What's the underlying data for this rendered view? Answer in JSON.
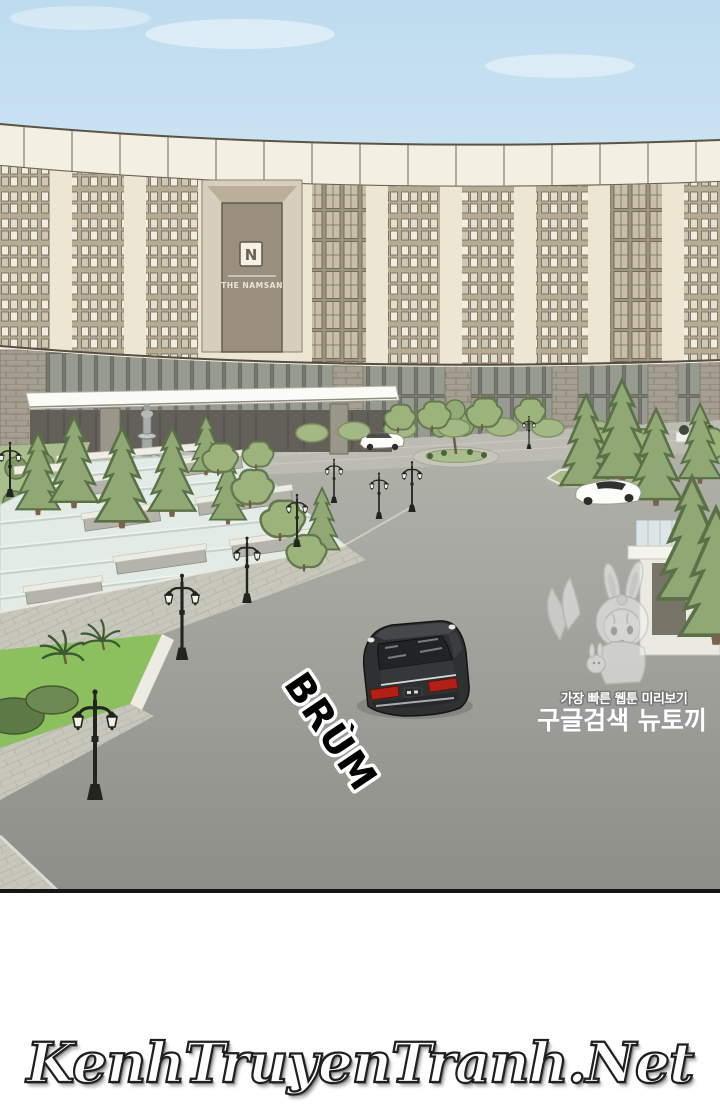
{
  "page": {
    "type": "webtoon-reader-page",
    "background_color": "#ffffff"
  },
  "panel": {
    "scene": "Aerial view of The Namsan hotel forecourt with fountain, cascading water steps, circular driveway and cars",
    "sky_color": "#c9e1f2",
    "road_color": "#a0a19a",
    "water_color": "#e2ebe6",
    "foliage_color": "#94ab76",
    "hotel": {
      "logo_letter": "N",
      "sign_text": "THE NAMSAN",
      "facade_color": "#ece6d3",
      "parapet_color": "#f3f0e3",
      "sign_panel_color": "#9a8f7e"
    },
    "sfx": {
      "text": "BRÙM",
      "fill_color": "#000000",
      "outline_color": "#ffffff"
    },
    "vehicles": [
      "black-sedan",
      "white-shuttle-car",
      "white-convertible"
    ],
    "taillight_color": "#b32015"
  },
  "watermark": {
    "tagline": "가장 빠른 웹툰 미리보기",
    "site_name": "구글검색 뉴토끼",
    "character": "bunny-hood-girl",
    "text_color": "#ffffff",
    "outline_color": "#8b8b8b"
  },
  "footer": {
    "site_name": "KenhTruyenTranh.Net",
    "text_color": "#ffffff",
    "outline_color": "#1f1f1f"
  }
}
